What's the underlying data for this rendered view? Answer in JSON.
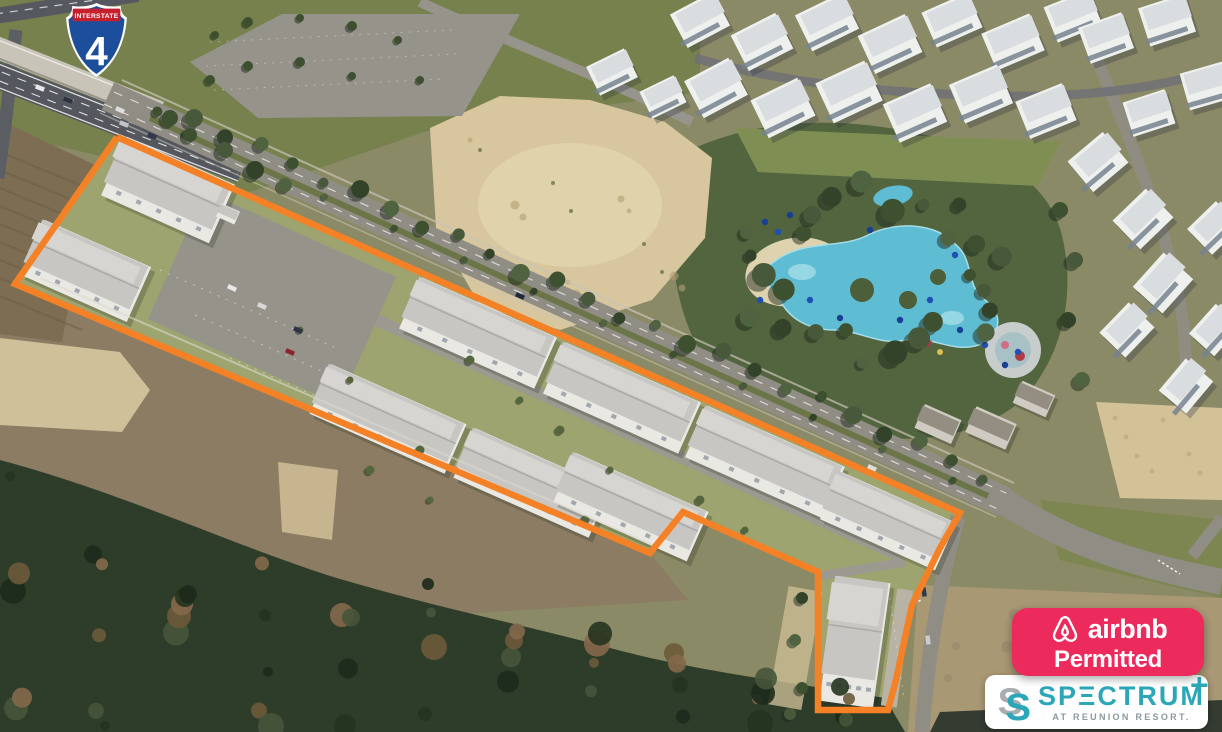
{
  "scene": {
    "type": "aerial-photograph",
    "description": "Oblique aerial photo of the Spectrum townhome parcel at Reunion Resort outlined in orange, beside Interstate 4, with surface parking lots, a divided boulevard, a resort water park with lagoon pools, white condo clusters, cleared sand lots and dense woodland."
  },
  "overlays": {
    "interstate_shield": {
      "banner": "INTERSTATE",
      "route_number": "4",
      "banner_color": "#c6202e",
      "shield_color": "#1c4e9c",
      "border_color": "#ffffff"
    },
    "airbnb_badge": {
      "icon": "airbnb-belo-icon",
      "brand": "airbnb",
      "status": "Permitted",
      "background_color": "#ec2a5c",
      "text_color": "#ffffff"
    },
    "spectrum_card": {
      "icon": "spectrum-s-icon",
      "name": "SPECTRUM",
      "display_wordmark": "SPΞCTRUM",
      "plus_mark": "+",
      "tagline": "AT REUNION RESORT.",
      "brand_color": "#2ba7b8",
      "icon_gray": "#a9adb1",
      "tagline_color": "#8a9aa0",
      "background_color": "#ffffff"
    },
    "property_boundary": {
      "color": "#f48125",
      "style": "solid outline around townhome parcel"
    }
  }
}
